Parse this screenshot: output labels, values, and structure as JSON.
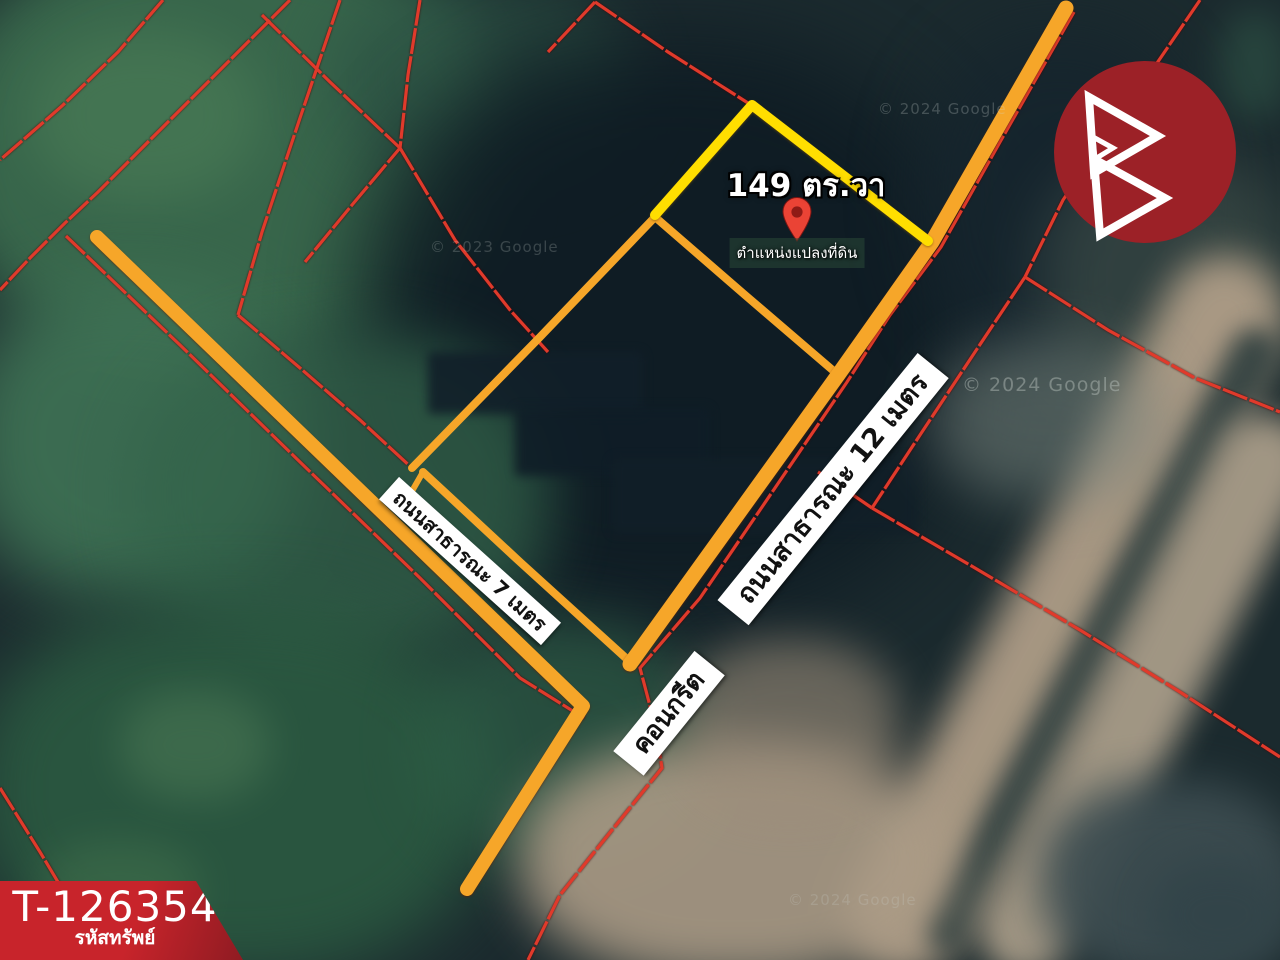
{
  "map": {
    "area_label": "149 ตร.วา",
    "pin_label": "ตำแหน่งแปลงที่ดิน",
    "road_7m_label": "ถนนสาธารณะ 7 เมตร",
    "road_12m_label": "ถนนสาธารณะ 12 เมตร",
    "concrete_label": "คอนกรีต",
    "watermarks": [
      "© 2024 Google",
      "© 2023 Google",
      "© 2024 Google",
      "© 2024 Google"
    ]
  },
  "badge": {
    "property_code": "T-126354",
    "property_code_caption": "รหัสทรัพย์"
  },
  "colors": {
    "road_highlight": "#F6A629",
    "subject_plot": "#FFDE00",
    "parcel_boundary": "#E03A2B",
    "pin": "#EA4335",
    "pin_hole": "#8E1B16",
    "logo_circle": "#9C2127",
    "logo_glyph": "#FFFFFF",
    "badge_red": "#C8242B",
    "badge_red_dark": "#8F1B22",
    "label_bg": "#FFFFFF",
    "label_text": "#111111"
  }
}
